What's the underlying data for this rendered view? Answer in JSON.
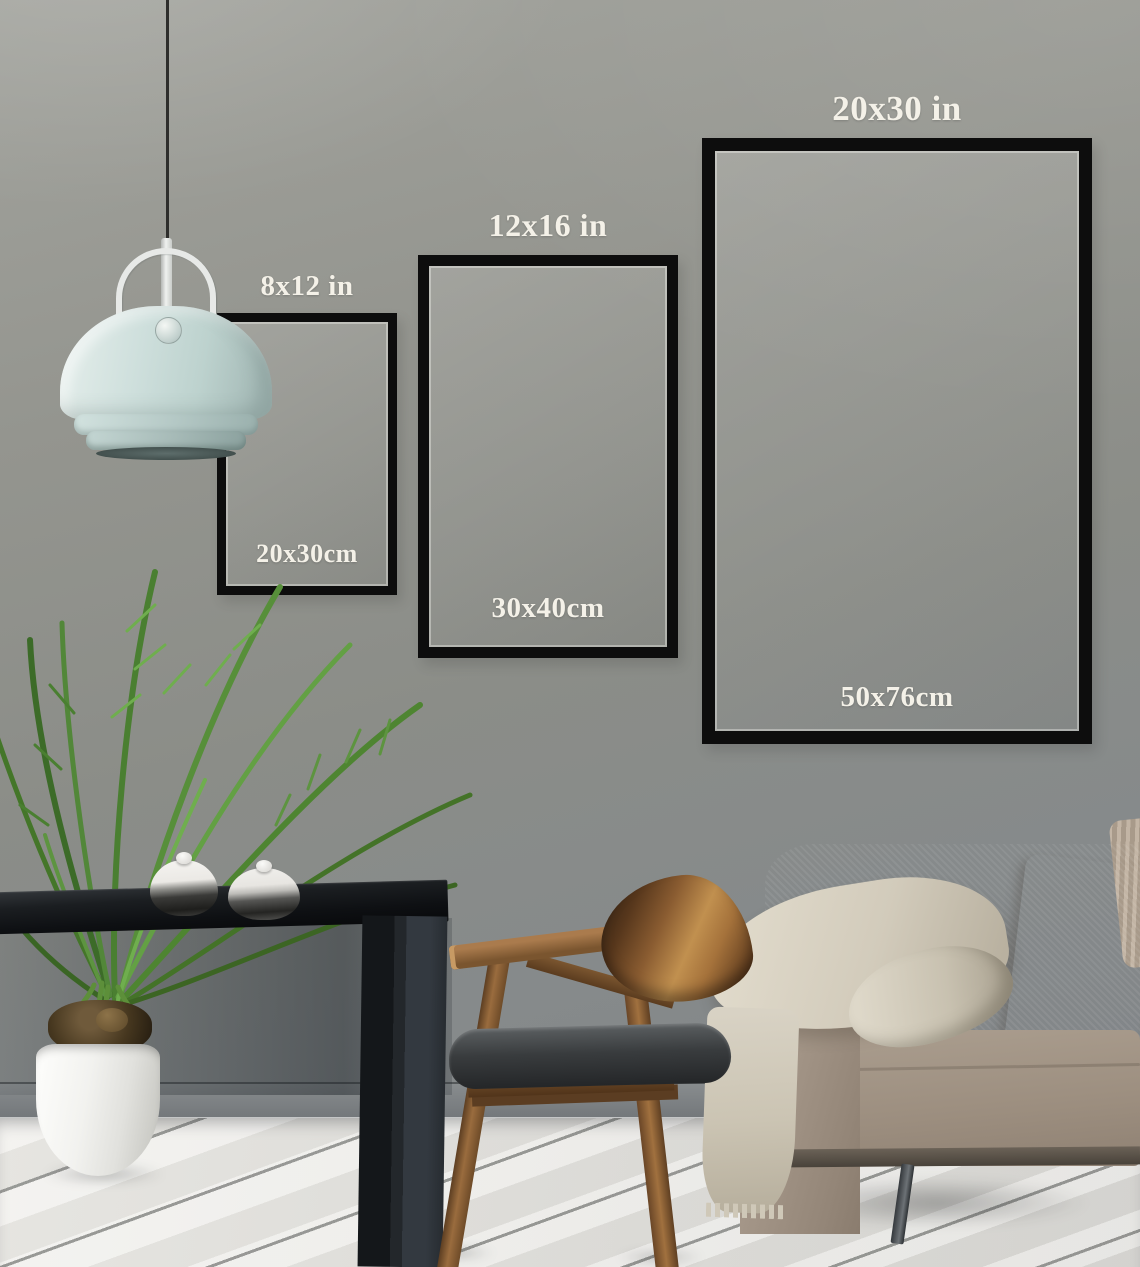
{
  "frames": {
    "small": {
      "inch_label": "8x12 in",
      "cm_label": "20x30cm"
    },
    "medium": {
      "inch_label": "12x16 in",
      "cm_label": "30x40cm"
    },
    "large": {
      "inch_label": "20x30 in",
      "cm_label": "50x76cm"
    }
  },
  "colors": {
    "frame-border": "#0d0d0d",
    "label-text": "#f4f1e8",
    "baseboard": "#888c8e",
    "floor-light": "#efeeea",
    "lamp-cord": "#2e2e2c",
    "lamp-metal": "#e7e9e7",
    "lamp-shade": "#cedfdc",
    "table-top": "#0e1013",
    "table-leg": "#23272b",
    "soil": "#46371f",
    "pot": "#f2f2ef",
    "plant-green": "#4e8531",
    "plant-dark": "#36591f",
    "teapot-white": "#f5f4f1",
    "teapot-dark": "#1e1e1c",
    "sofa-body": "#a09283",
    "sofa-light": "#b3a597",
    "sofa-dark": "#8a7c6e",
    "pillow": "#ab9d8e",
    "blanket": "#d7d1c3",
    "blanket-shade": "#b9b1a0",
    "sofa-leg": "#34383c",
    "wood": "#8a5c31",
    "wood-dark": "#5d3a1d",
    "seat-dark": "#393c3e"
  }
}
